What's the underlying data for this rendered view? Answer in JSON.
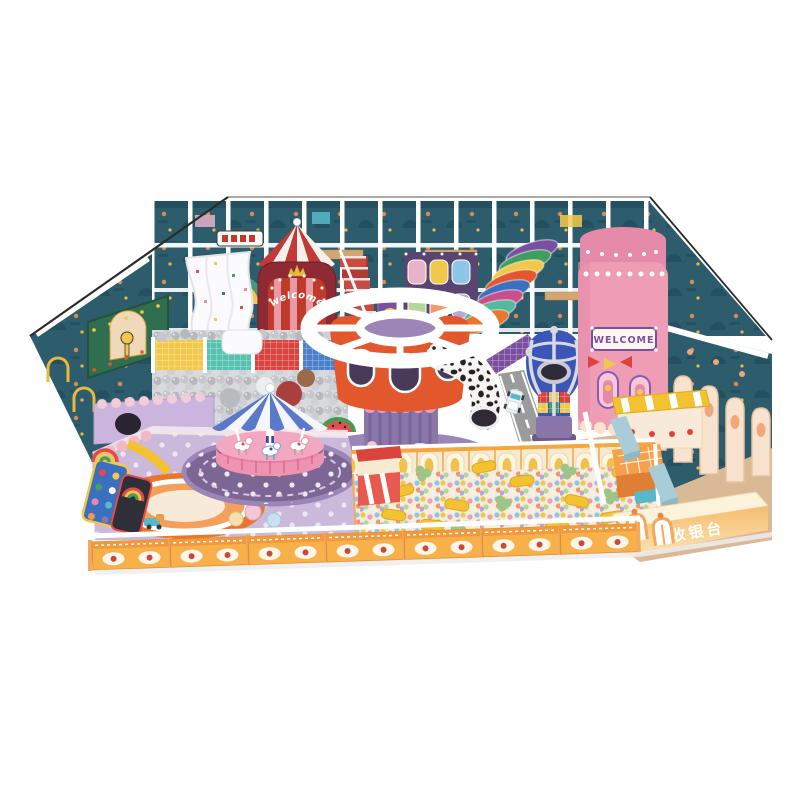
{
  "signs": {
    "tent_welcome": "welcome",
    "castle_welcome": "WELCOME",
    "cashier_desk": "收银台"
  },
  "palette": {
    "background": "#ffffff",
    "wall_teal": "#2d5d6d",
    "wall_teal_dark": "#24505f",
    "frame_white": "#ffffff",
    "gray_balls": "#c6c7cb",
    "tent_red": "#c13a38",
    "tent_arch_maroon": "#8e2a33",
    "tower_orange": "#e2572b",
    "tower_purple": "#8a76a8",
    "carousel_blue": "#5b79c9",
    "carousel_pink": "#e77fa3",
    "rug_purple": "#7b6694",
    "floor_lavender": "#cbb9dc",
    "rug_orange": "#e8762d",
    "pit_wall_cream": "#f7ead0",
    "pit_ball_yellow": "#f2c84b",
    "fence_orange": "#f7b04a",
    "castle_pink": "#ef9db4",
    "balloon_blue": "#3b55b8",
    "road_gray": "#9b9b9b",
    "floor_tan": "#dab997",
    "bench_blue": "#a9cdd8",
    "counter_peach": "#f6bd6e",
    "whale_yellow": "#f5c531",
    "outline_dark": "#2b2b2b"
  }
}
